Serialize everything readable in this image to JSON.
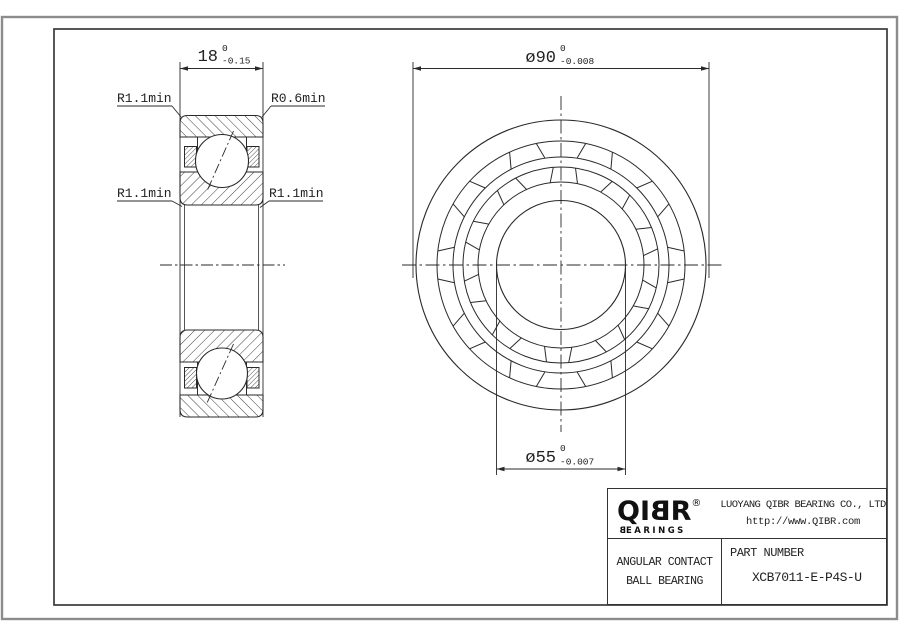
{
  "drawing": {
    "dim_width": {
      "value": "18",
      "tol_upper": "0",
      "tol_lower": "-0.15"
    },
    "dim_outer": {
      "value": "ø90",
      "tol_upper": "0",
      "tol_lower": "-0.008"
    },
    "dim_bore": {
      "value": "ø55",
      "tol_upper": "0",
      "tol_lower": "-0.007"
    },
    "radius_labels": {
      "top_left": "R1.1min",
      "top_right": "R0.6min",
      "bottom_left": "R1.1min",
      "bottom_right": "R1.1min"
    }
  },
  "title_block": {
    "logo": {
      "part1": "QI",
      "part2": "B",
      "part3": "R",
      "registered": "®",
      "tagline_b": "B",
      "tagline_rest": "EARINGS"
    },
    "company": "LUOYANG QIBR BEARING CO., LTD",
    "website": "http://www.QIBR.com",
    "product_line1": "ANGULAR CONTACT",
    "product_line2": "BALL BEARING",
    "part_label": "PART NUMBER",
    "part_number": "XCB7011-E-P4S-U"
  },
  "colors": {
    "line": "#2a2a2a",
    "frame_outer": "#8c8c8c",
    "frame_inner": "#3a3a3a",
    "background": "#ffffff"
  }
}
